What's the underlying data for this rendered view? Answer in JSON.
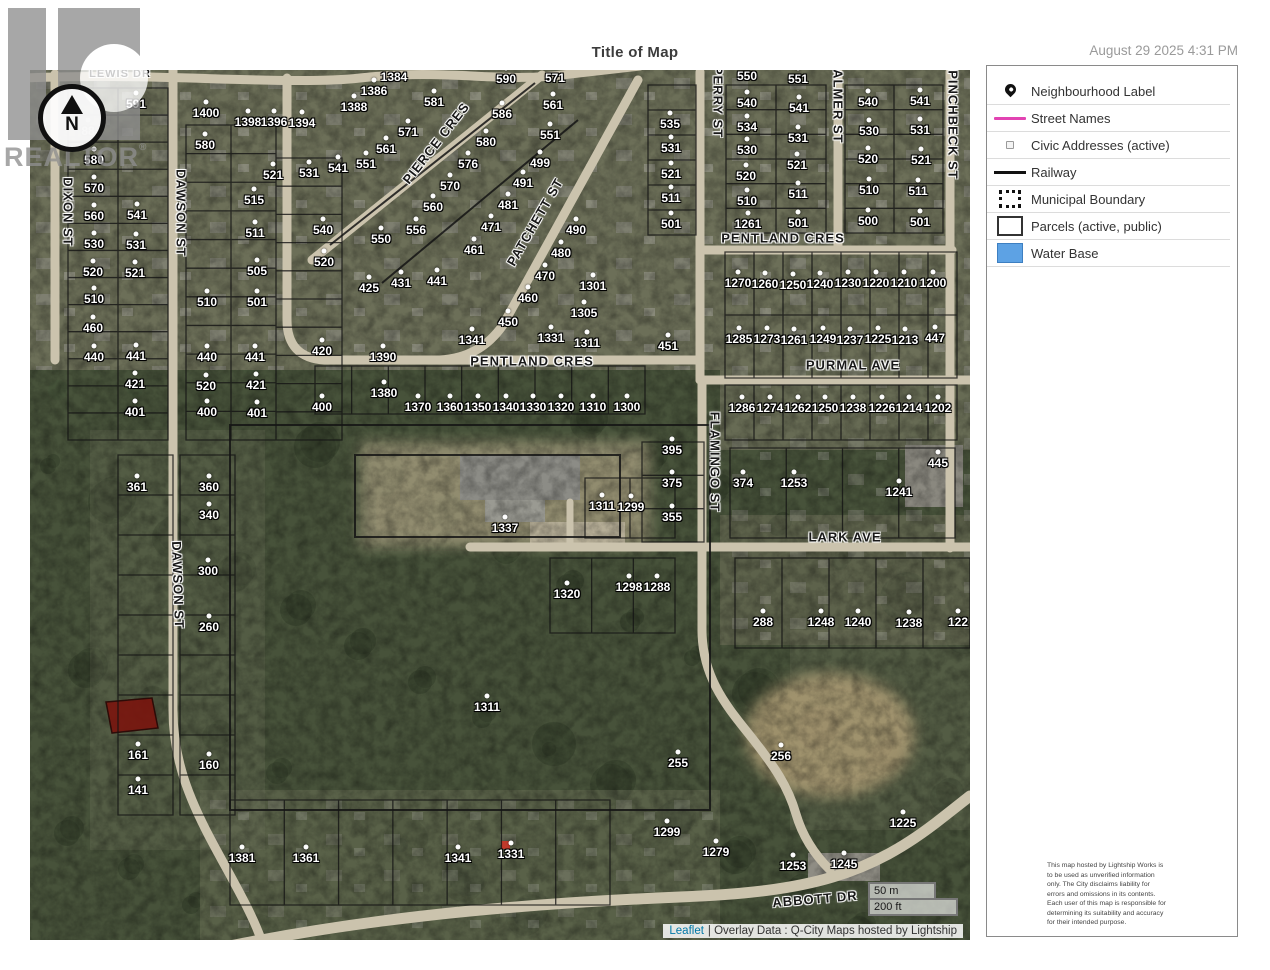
{
  "header": {
    "title": "Title of Map",
    "timestamp": "August 29 2025 4:31 PM"
  },
  "logo": {
    "text": "REALTOR",
    "reg": "®"
  },
  "compass": {
    "north": "N"
  },
  "legend": {
    "items": [
      {
        "label": "Neighbourhood Label",
        "swatch": "pin",
        "icon": "map-pin-icon"
      },
      {
        "label": "Street Names",
        "swatch": "street",
        "color": "#e243b2"
      },
      {
        "label": "Civic Addresses (active)",
        "swatch": "civic"
      },
      {
        "label": "Railway",
        "swatch": "rail",
        "color": "#111111"
      },
      {
        "label": "Municipal Boundary",
        "swatch": "muni"
      },
      {
        "label": "Parcels (active, public)",
        "swatch": "parcel"
      },
      {
        "label": "Water Base",
        "swatch": "water",
        "color": "#5da2e4"
      }
    ]
  },
  "scalebar": {
    "metric": "50 m",
    "imperial": "200 ft"
  },
  "attribution": {
    "link": "Leaflet",
    "rest": "| Overlay Data : Q-City Maps hosted by Lightship"
  },
  "panel": {
    "disclaimer": "This map hosted by Lightship Works is to be used as unverified information only. The City disclaims liability for errors and omissions in its contents. Each user of this map is responsible for determining its suitability and accuracy for their intended purpose."
  },
  "map": {
    "highlight_parcel_color": "#7a150e",
    "road_color": "#cbc3ad",
    "streets": [
      {
        "t": "LEWIS DR",
        "x": 90,
        "y": 4,
        "r": 0,
        "s": 11
      },
      {
        "t": "DIXON ST",
        "x": 38,
        "y": 142,
        "r": 90
      },
      {
        "t": "DAWSON ST",
        "x": 151,
        "y": 143,
        "r": 90
      },
      {
        "t": "PIERCE CRES",
        "x": 406,
        "y": 73,
        "r": -52
      },
      {
        "t": "PATCHETT ST",
        "x": 505,
        "y": 152,
        "r": -60
      },
      {
        "t": "PENTLAND CRES",
        "x": 502,
        "y": 291,
        "r": 0
      },
      {
        "t": "PENTLAND CRES",
        "x": 753,
        "y": 168,
        "r": 0
      },
      {
        "t": "PERRY ST",
        "x": 688,
        "y": 32,
        "r": 90
      },
      {
        "t": "PALMER ST",
        "x": 808,
        "y": 32,
        "r": 90
      },
      {
        "t": "PINCHBECK ST",
        "x": 923,
        "y": 55,
        "r": 90
      },
      {
        "t": "PURMAL AVE",
        "x": 823,
        "y": 295,
        "r": 0
      },
      {
        "t": "FLAMINGO ST",
        "x": 685,
        "y": 392,
        "r": 90
      },
      {
        "t": "LARK AVE",
        "x": 815,
        "y": 467,
        "r": 0
      },
      {
        "t": "DAWSON ST",
        "x": 148,
        "y": 515,
        "r": 88
      },
      {
        "t": "ABBOTT DR",
        "x": 785,
        "y": 829,
        "r": -5
      }
    ],
    "parcels": [
      {
        "t": "591",
        "x": 106,
        "y": 34
      },
      {
        "t": "88",
        "x": 58,
        "y": 61
      },
      {
        "t": "580",
        "x": 64,
        "y": 90
      },
      {
        "t": "570",
        "x": 64,
        "y": 118
      },
      {
        "t": "560",
        "x": 64,
        "y": 146
      },
      {
        "t": "541",
        "x": 107,
        "y": 145
      },
      {
        "t": "530",
        "x": 64,
        "y": 174
      },
      {
        "t": "531",
        "x": 106,
        "y": 175
      },
      {
        "t": "520",
        "x": 63,
        "y": 202
      },
      {
        "t": "521",
        "x": 105,
        "y": 203
      },
      {
        "t": "510",
        "x": 64,
        "y": 229
      },
      {
        "t": "460",
        "x": 63,
        "y": 258
      },
      {
        "t": "440",
        "x": 64,
        "y": 287
      },
      {
        "t": "441",
        "x": 106,
        "y": 286
      },
      {
        "t": "421",
        "x": 105,
        "y": 314
      },
      {
        "t": "401",
        "x": 105,
        "y": 342
      },
      {
        "t": "1400",
        "x": 176,
        "y": 43
      },
      {
        "t": "580",
        "x": 175,
        "y": 75
      },
      {
        "t": "1398",
        "x": 218,
        "y": 52
      },
      {
        "t": "1396",
        "x": 244,
        "y": 52
      },
      {
        "t": "1394",
        "x": 272,
        "y": 53
      },
      {
        "t": "510",
        "x": 177,
        "y": 232
      },
      {
        "t": "440",
        "x": 177,
        "y": 287
      },
      {
        "t": "520",
        "x": 176,
        "y": 316
      },
      {
        "t": "400",
        "x": 177,
        "y": 342
      },
      {
        "t": "521",
        "x": 243,
        "y": 105
      },
      {
        "t": "515",
        "x": 224,
        "y": 130
      },
      {
        "t": "511",
        "x": 225,
        "y": 163
      },
      {
        "t": "505",
        "x": 227,
        "y": 201
      },
      {
        "t": "501",
        "x": 227,
        "y": 232
      },
      {
        "t": "441",
        "x": 225,
        "y": 287
      },
      {
        "t": "421",
        "x": 226,
        "y": 315
      },
      {
        "t": "401",
        "x": 227,
        "y": 343
      },
      {
        "t": "531",
        "x": 279,
        "y": 103
      },
      {
        "t": "540",
        "x": 293,
        "y": 160
      },
      {
        "t": "520",
        "x": 294,
        "y": 192
      },
      {
        "t": "420",
        "x": 292,
        "y": 281
      },
      {
        "t": "400",
        "x": 292,
        "y": 337
      },
      {
        "t": "1384",
        "x": 364,
        "y": 7
      },
      {
        "t": "1386",
        "x": 344,
        "y": 21
      },
      {
        "t": "1388",
        "x": 324,
        "y": 37
      },
      {
        "t": "581",
        "x": 404,
        "y": 32
      },
      {
        "t": "571",
        "x": 378,
        "y": 62
      },
      {
        "t": "561",
        "x": 356,
        "y": 79
      },
      {
        "t": "551",
        "x": 336,
        "y": 94
      },
      {
        "t": "541",
        "x": 308,
        "y": 98
      },
      {
        "t": "590",
        "x": 476,
        "y": 9
      },
      {
        "t": "586",
        "x": 472,
        "y": 44
      },
      {
        "t": "580",
        "x": 456,
        "y": 72
      },
      {
        "t": "576",
        "x": 438,
        "y": 94
      },
      {
        "t": "570",
        "x": 420,
        "y": 116
      },
      {
        "t": "560",
        "x": 403,
        "y": 137
      },
      {
        "t": "556",
        "x": 386,
        "y": 160
      },
      {
        "t": "550",
        "x": 351,
        "y": 169
      },
      {
        "t": "425",
        "x": 339,
        "y": 218
      },
      {
        "t": "431",
        "x": 371,
        "y": 213
      },
      {
        "t": "441",
        "x": 407,
        "y": 211
      },
      {
        "t": "571",
        "x": 525,
        "y": 8
      },
      {
        "t": "561",
        "x": 523,
        "y": 35
      },
      {
        "t": "551",
        "x": 520,
        "y": 65
      },
      {
        "t": "499",
        "x": 510,
        "y": 93
      },
      {
        "t": "491",
        "x": 493,
        "y": 113
      },
      {
        "t": "481",
        "x": 478,
        "y": 135
      },
      {
        "t": "471",
        "x": 461,
        "y": 157
      },
      {
        "t": "461",
        "x": 444,
        "y": 180
      },
      {
        "t": "490",
        "x": 546,
        "y": 160
      },
      {
        "t": "480",
        "x": 531,
        "y": 183
      },
      {
        "t": "470",
        "x": 515,
        "y": 206
      },
      {
        "t": "460",
        "x": 498,
        "y": 228
      },
      {
        "t": "450",
        "x": 478,
        "y": 252
      },
      {
        "t": "1301",
        "x": 563,
        "y": 216
      },
      {
        "t": "1305",
        "x": 554,
        "y": 243
      },
      {
        "t": "1331",
        "x": 521,
        "y": 268
      },
      {
        "t": "1311",
        "x": 557,
        "y": 273
      },
      {
        "t": "1341",
        "x": 442,
        "y": 270
      },
      {
        "t": "1390",
        "x": 353,
        "y": 287
      },
      {
        "t": "1380",
        "x": 354,
        "y": 323
      },
      {
        "t": "1370",
        "x": 388,
        "y": 337
      },
      {
        "t": "1360",
        "x": 420,
        "y": 337
      },
      {
        "t": "1350",
        "x": 448,
        "y": 337
      },
      {
        "t": "1340",
        "x": 476,
        "y": 337
      },
      {
        "t": "1330",
        "x": 503,
        "y": 337
      },
      {
        "t": "1320",
        "x": 531,
        "y": 337
      },
      {
        "t": "1310",
        "x": 563,
        "y": 337
      },
      {
        "t": "1300",
        "x": 597,
        "y": 337
      },
      {
        "t": "535",
        "x": 640,
        "y": 54
      },
      {
        "t": "531",
        "x": 641,
        "y": 78
      },
      {
        "t": "521",
        "x": 641,
        "y": 104
      },
      {
        "t": "511",
        "x": 641,
        "y": 128
      },
      {
        "t": "501",
        "x": 641,
        "y": 154
      },
      {
        "t": "451",
        "x": 638,
        "y": 276
      },
      {
        "t": "1261",
        "x": 718,
        "y": 154
      },
      {
        "t": "550",
        "x": 717,
        "y": 6
      },
      {
        "t": "540",
        "x": 717,
        "y": 33
      },
      {
        "t": "534",
        "x": 717,
        "y": 57
      },
      {
        "t": "530",
        "x": 717,
        "y": 80
      },
      {
        "t": "520",
        "x": 716,
        "y": 106
      },
      {
        "t": "510",
        "x": 717,
        "y": 131
      },
      {
        "t": "551",
        "x": 768,
        "y": 9
      },
      {
        "t": "541",
        "x": 769,
        "y": 38
      },
      {
        "t": "531",
        "x": 768,
        "y": 68
      },
      {
        "t": "521",
        "x": 767,
        "y": 95
      },
      {
        "t": "511",
        "x": 768,
        "y": 124
      },
      {
        "t": "501",
        "x": 768,
        "y": 153
      },
      {
        "t": "540",
        "x": 838,
        "y": 32
      },
      {
        "t": "530",
        "x": 839,
        "y": 61
      },
      {
        "t": "520",
        "x": 838,
        "y": 89
      },
      {
        "t": "510",
        "x": 839,
        "y": 120
      },
      {
        "t": "500",
        "x": 838,
        "y": 151
      },
      {
        "t": "541",
        "x": 890,
        "y": 31
      },
      {
        "t": "531",
        "x": 890,
        "y": 60
      },
      {
        "t": "521",
        "x": 891,
        "y": 90
      },
      {
        "t": "511",
        "x": 888,
        "y": 121
      },
      {
        "t": "501",
        "x": 890,
        "y": 152
      },
      {
        "t": "1270",
        "x": 708,
        "y": 213
      },
      {
        "t": "1260",
        "x": 735,
        "y": 214
      },
      {
        "t": "1250",
        "x": 763,
        "y": 215
      },
      {
        "t": "1240",
        "x": 790,
        "y": 214
      },
      {
        "t": "1230",
        "x": 818,
        "y": 213
      },
      {
        "t": "1220",
        "x": 846,
        "y": 213
      },
      {
        "t": "1210",
        "x": 874,
        "y": 213
      },
      {
        "t": "1200",
        "x": 903,
        "y": 213
      },
      {
        "t": "1285",
        "x": 709,
        "y": 269
      },
      {
        "t": "1273",
        "x": 737,
        "y": 269
      },
      {
        "t": "1261",
        "x": 764,
        "y": 270
      },
      {
        "t": "1249",
        "x": 793,
        "y": 269
      },
      {
        "t": "1237",
        "x": 820,
        "y": 270
      },
      {
        "t": "1225",
        "x": 848,
        "y": 269
      },
      {
        "t": "1213",
        "x": 875,
        "y": 270
      },
      {
        "t": "447",
        "x": 905,
        "y": 268
      },
      {
        "t": "1286",
        "x": 712,
        "y": 338
      },
      {
        "t": "1274",
        "x": 740,
        "y": 338
      },
      {
        "t": "1262",
        "x": 768,
        "y": 338
      },
      {
        "t": "1250",
        "x": 795,
        "y": 338
      },
      {
        "t": "1238",
        "x": 823,
        "y": 338
      },
      {
        "t": "1226",
        "x": 852,
        "y": 338
      },
      {
        "t": "1214",
        "x": 879,
        "y": 338
      },
      {
        "t": "1202",
        "x": 908,
        "y": 338
      },
      {
        "t": "395",
        "x": 642,
        "y": 380
      },
      {
        "t": "375",
        "x": 642,
        "y": 413
      },
      {
        "t": "355",
        "x": 642,
        "y": 447
      },
      {
        "t": "1311",
        "x": 572,
        "y": 436
      },
      {
        "t": "1299",
        "x": 601,
        "y": 437
      },
      {
        "t": "1337",
        "x": 475,
        "y": 458
      },
      {
        "t": "374",
        "x": 713,
        "y": 413
      },
      {
        "t": "1253",
        "x": 764,
        "y": 413
      },
      {
        "t": "1241",
        "x": 869,
        "y": 422
      },
      {
        "t": "445",
        "x": 908,
        "y": 393
      },
      {
        "t": "1320",
        "x": 537,
        "y": 524
      },
      {
        "t": "1298",
        "x": 599,
        "y": 517
      },
      {
        "t": "1288",
        "x": 627,
        "y": 517
      },
      {
        "t": "288",
        "x": 733,
        "y": 552
      },
      {
        "t": "1248",
        "x": 791,
        "y": 552
      },
      {
        "t": "1240",
        "x": 828,
        "y": 552
      },
      {
        "t": "1238",
        "x": 879,
        "y": 553
      },
      {
        "t": "122",
        "x": 928,
        "y": 552
      },
      {
        "t": "361",
        "x": 107,
        "y": 417
      },
      {
        "t": "360",
        "x": 179,
        "y": 417
      },
      {
        "t": "340",
        "x": 179,
        "y": 445
      },
      {
        "t": "300",
        "x": 178,
        "y": 501
      },
      {
        "t": "260",
        "x": 179,
        "y": 557
      },
      {
        "t": "161",
        "x": 108,
        "y": 685
      },
      {
        "t": "160",
        "x": 179,
        "y": 695
      },
      {
        "t": "141",
        "x": 108,
        "y": 720
      },
      {
        "t": "1311",
        "x": 457,
        "y": 637
      },
      {
        "t": "255",
        "x": 648,
        "y": 693
      },
      {
        "t": "256",
        "x": 751,
        "y": 686
      },
      {
        "t": "1225",
        "x": 873,
        "y": 753
      },
      {
        "t": "1299",
        "x": 637,
        "y": 762
      },
      {
        "t": "1279",
        "x": 686,
        "y": 782
      },
      {
        "t": "1253",
        "x": 763,
        "y": 796
      },
      {
        "t": "1245",
        "x": 814,
        "y": 794
      },
      {
        "t": "1381",
        "x": 212,
        "y": 788
      },
      {
        "t": "1361",
        "x": 276,
        "y": 788
      },
      {
        "t": "1341",
        "x": 428,
        "y": 788
      },
      {
        "t": "1331",
        "x": 481,
        "y": 784
      }
    ]
  }
}
